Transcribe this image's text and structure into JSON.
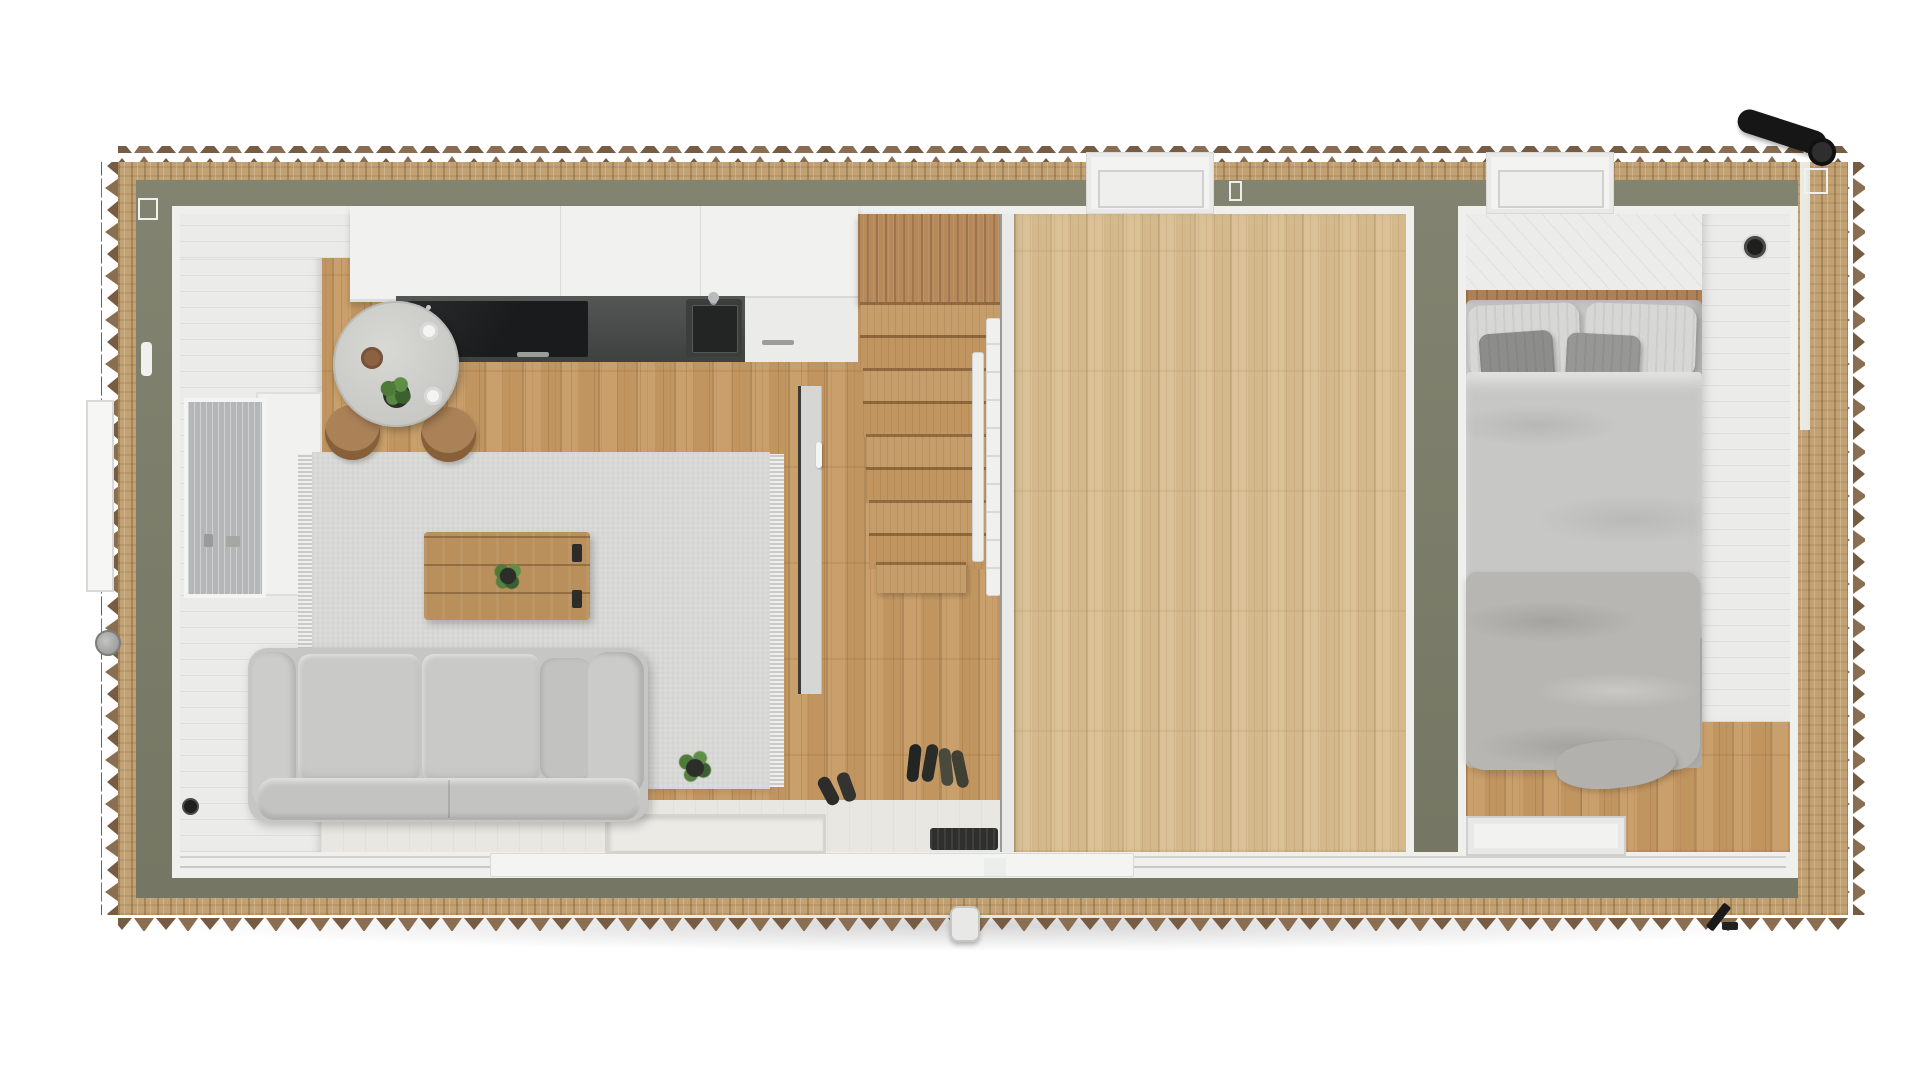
{
  "scene": {
    "description": "Top-down 3D cutaway floor plan render of a tiny house (container home) with no visible text",
    "view": "top-down section",
    "rooms": [
      {
        "name": "living-dining-kitchen",
        "contents": [
          "round dining table",
          "two wooden chairs",
          "kitchen counter with cooktop and sink",
          "white upper cabinets",
          "area rug with fringe",
          "wooden crate coffee table with plant",
          "two-seat gray sofa",
          "floor plant",
          "shoes at entry",
          "left wall window",
          "sliding entry door",
          "recessed entry tray"
        ]
      },
      {
        "name": "stair-hall",
        "contents": [
          "wood staircase",
          "tall wood stair panel",
          "white loft railing",
          "partition wall with handle",
          "boot tray"
        ]
      },
      {
        "name": "loft-platform",
        "contents": [
          "large light wood loft deck"
        ]
      },
      {
        "name": "bedroom",
        "contents": [
          "double bed",
          "two striped pillows",
          "two dark gray cushions",
          "striped duvet",
          "gray blanket",
          "headboard beam",
          "white plank wall",
          "round wall vent",
          "top window",
          "glass threshold panel"
        ]
      }
    ],
    "exterior": [
      "sawtooth timber cladding",
      "insulation layer",
      "olive-green structural wall ring",
      "two top-wall windows",
      "black chimney pipe",
      "exterior sliding-door handle",
      "left window exterior frame with knob",
      "corner trim markers",
      "bottom-right hinge"
    ]
  },
  "stairs": {
    "treads": 8,
    "has-wide-bottom-tread": true
  },
  "palette": {
    "background": "#ffffff",
    "cladding_teeth": "#8a6e52",
    "cladding_teeth_dark": "#755c42",
    "osb": "#c2a273",
    "wall_green": "#7b7d69",
    "trim_white": "#eff0ec",
    "floor_wood": "#c69a63",
    "loft_wood": "#d9bd90",
    "stair_wood": "#c49d6b",
    "stair_panel": "#b5895a",
    "interior_wall_white": "#ebebe9",
    "deck_white": "#e9e7e1",
    "rug": "#dbdbd9",
    "sofa": "#c6c6c4",
    "table_top": "#cfcfcb",
    "chair_wood": "#ab8157",
    "crate_wood": "#b9905b",
    "cabinet_white": "#f1f1ef",
    "counter_dark": "#464848",
    "cooktop_black": "#191b1c",
    "plant_green": "#4e7a3a",
    "bedding_light": "#d7d7d5",
    "bedding_mid": "#c6c6c4",
    "bedding_dark": "#8d8d8b",
    "blanket": "#b7b6b2",
    "glass": "#b4b7b8",
    "pipe_black": "#161616"
  }
}
